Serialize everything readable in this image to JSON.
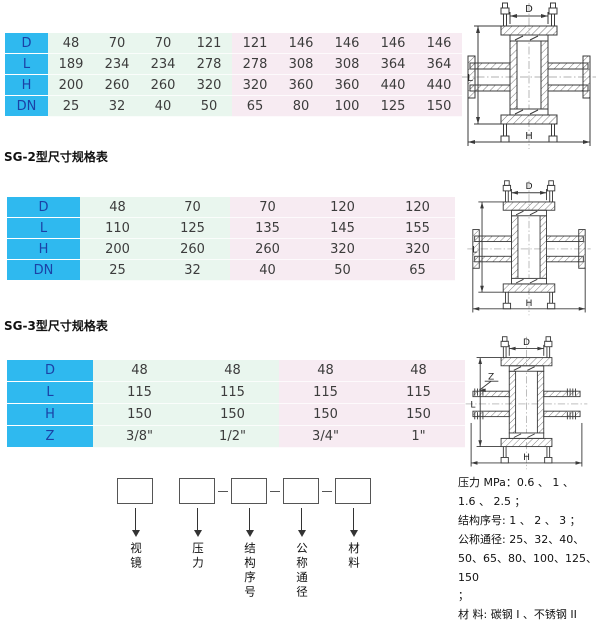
{
  "colors": {
    "header_bg": "#2FB9EF",
    "header_text": "#1B41A6",
    "cell_green": "#E9F6EE",
    "cell_pink": "#F7EBF2",
    "line_ink": "#3A3A3A"
  },
  "tables": [
    {
      "name": "SG-1",
      "caption": "",
      "green_columns": 4,
      "rows": [
        {
          "label": "D",
          "values": [
            "48",
            "70",
            "70",
            "121",
            "121",
            "146",
            "146",
            "146",
            "146"
          ]
        },
        {
          "label": "L",
          "values": [
            "189",
            "234",
            "234",
            "278",
            "278",
            "308",
            "308",
            "364",
            "364"
          ]
        },
        {
          "label": "H",
          "values": [
            "200",
            "260",
            "260",
            "320",
            "320",
            "360",
            "360",
            "440",
            "440"
          ]
        },
        {
          "label": "DN",
          "values": [
            "25",
            "32",
            "40",
            "50",
            "65",
            "80",
            "100",
            "125",
            "150"
          ]
        }
      ]
    },
    {
      "name": "SG-2",
      "caption": "SG-2型尺寸规格表",
      "green_columns": 2,
      "rows": [
        {
          "label": "D",
          "values": [
            "48",
            "70",
            "70",
            "120",
            "120"
          ]
        },
        {
          "label": "L",
          "values": [
            "110",
            "125",
            "135",
            "145",
            "155"
          ]
        },
        {
          "label": "H",
          "values": [
            "200",
            "260",
            "260",
            "320",
            "320"
          ]
        },
        {
          "label": "DN",
          "values": [
            "25",
            "32",
            "40",
            "50",
            "65"
          ]
        }
      ]
    },
    {
      "name": "SG-3",
      "caption": "SG-3型尺寸规格表",
      "green_columns": 2,
      "rows": [
        {
          "label": "D",
          "values": [
            "48",
            "48",
            "48",
            "48"
          ]
        },
        {
          "label": "L",
          "values": [
            "115",
            "115",
            "115",
            "115"
          ]
        },
        {
          "label": "H",
          "values": [
            "150",
            "150",
            "150",
            "150"
          ]
        },
        {
          "label": "Z",
          "values": [
            "3/8\"",
            "1/2\"",
            "3/4\"",
            "1\""
          ]
        }
      ]
    }
  ],
  "designation": {
    "boxes": [
      {
        "label": "视镜",
        "dash_before": false
      },
      {
        "label": "压力",
        "dash_before": false
      },
      {
        "label": "结构序号",
        "dash_before": true
      },
      {
        "label": "公称通径",
        "dash_before": true
      },
      {
        "label": "材料",
        "dash_before": true
      }
    ]
  },
  "drawings": [
    {
      "dims": {
        "top": "D",
        "left": "L",
        "bottom": "H"
      }
    },
    {
      "dims": {
        "top": "D",
        "left": "L",
        "bottom": "H"
      }
    },
    {
      "dims": {
        "top": "D",
        "left": "L",
        "bottom": "H",
        "side": "Z"
      }
    }
  ],
  "notes": {
    "lines": "压力 MPa：0.6 、 1 、\n1.6 、 2.5 ；\n结构序号: 1 、 2 、 3 ；\n公称通径: 25、32、40、\n50、65、80、100、125、150\n；\n材 料: 碳钢 I 、不锈钢 II\n。"
  }
}
